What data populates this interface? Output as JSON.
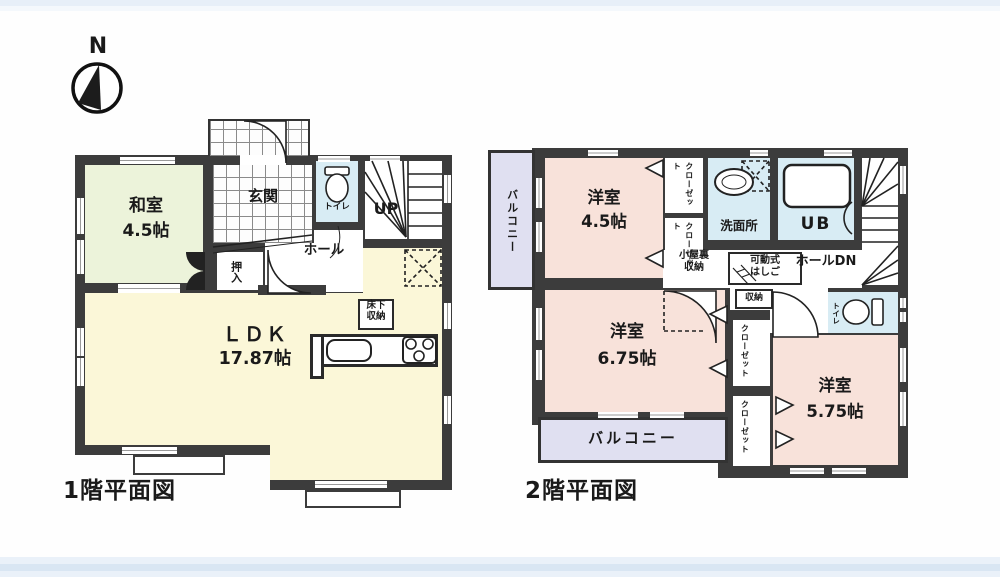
{
  "compass": {
    "north_label": "N"
  },
  "floor1": {
    "title": "1階平面図",
    "washitsu_name": "和室",
    "washitsu_size": "4.5帖",
    "genkan": "玄関",
    "oshiire": "押入",
    "toilet": "トイレ",
    "hall": "ホール",
    "stairs_up": "UP",
    "ldk_name": "ＬＤＫ",
    "ldk_size": "17.87帖",
    "yukashita_line1": "床下",
    "yukashita_line2": "収納"
  },
  "floor2": {
    "title": "2階平面図",
    "balcony_left": "バルコニー",
    "room45_name": "洋室",
    "room45_size": "4.5帖",
    "closet_a_col1": "クロー",
    "closet_a_col2": "ゼット",
    "closet_b_col1": "クロー",
    "closet_b_col2": "ゼット",
    "senmenjo": "洗面所",
    "ub": "UB",
    "koyaura_line1": "小屋裏",
    "koyaura_line2": "収納",
    "hashigo_line1": "可動式",
    "hashigo_line2": "はしご",
    "hall_dn": "ホールDN",
    "shuno": "収納",
    "toilet": "トイレ",
    "room675_name": "洋室",
    "room675_size": "6.75帖",
    "closet_c_col1": "クロー",
    "closet_c_col2": "ゼット",
    "balcony_bottom": "バルコニー",
    "closet_d_col1": "クロー",
    "closet_d_col2": "ゼット",
    "room575_name": "洋室",
    "room575_size": "5.75帖"
  },
  "colors": {
    "wall": "#3c3c3c",
    "tatami_room": "#ecf3da",
    "ldk": "#fbf7d8",
    "western_room": "#f8e2da",
    "wet_area": "#d8ecf4",
    "balcony": "#e0e0f1"
  }
}
